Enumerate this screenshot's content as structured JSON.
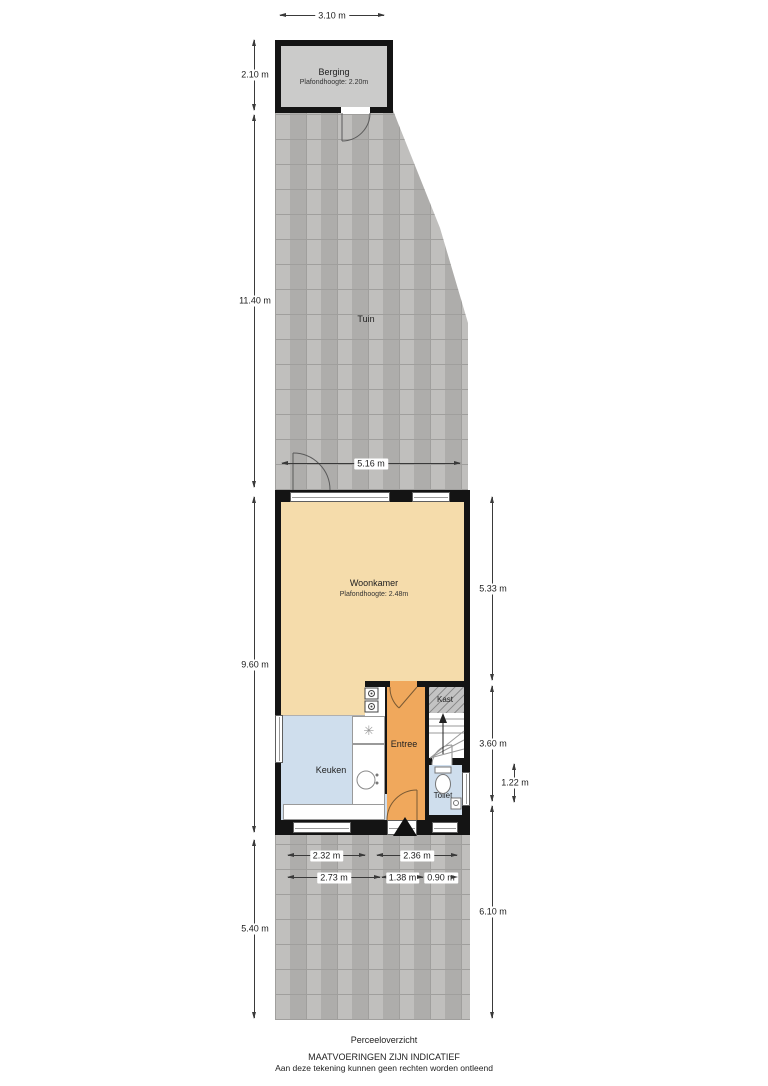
{
  "footer": {
    "plan_title": "Perceeloverzicht",
    "disclaimer_line1": "MAATVOERINGEN ZIJN INDICATIEF",
    "disclaimer_line2": "Aan deze tekening kunnen geen rechten worden ontleend"
  },
  "rooms": {
    "berging": {
      "label": "Berging",
      "ceiling": "Plafondhoogte: 2.20m"
    },
    "tuin": {
      "label": "Tuin"
    },
    "woonkamer": {
      "label": "Woonkamer",
      "ceiling": "Plafondhoogte: 2.48m"
    },
    "keuken": {
      "label": "Keuken"
    },
    "entree": {
      "label": "Entree"
    },
    "kast": {
      "label": "Kast"
    },
    "toilet": {
      "label": "Toilet"
    }
  },
  "dimensions": {
    "shed_width": "3.10 m",
    "shed_depth": "2.10 m",
    "garden_depth": "11.40 m",
    "house_front_width": "5.16 m",
    "house_depth": "9.60 m",
    "woonkamer_depth": "5.33 m",
    "entree_depth": "3.60 m",
    "toilet_depth": "1.22 m",
    "rear_garden_depth_left": "5.40 m",
    "rear_garden_depth_right": "6.10 m",
    "keuken_width": "2.32 m",
    "entree_toilet_width": "2.36 m",
    "keuken_inner_width": "2.73 m",
    "entree_inner_width": "1.38 m",
    "toilet_inner_width": "0.90 m"
  },
  "icons": {
    "ventilation_unit": "✳"
  },
  "colors": {
    "wall": "#141414",
    "woonkamer_floor": "#f5dcab",
    "entree_floor": "#f0a85c",
    "wet_room_floor": "#cfdeed",
    "berging_floor": "#cbcbca",
    "paving": "#b7b6b4",
    "dimension_line": "#3a3a3a"
  }
}
